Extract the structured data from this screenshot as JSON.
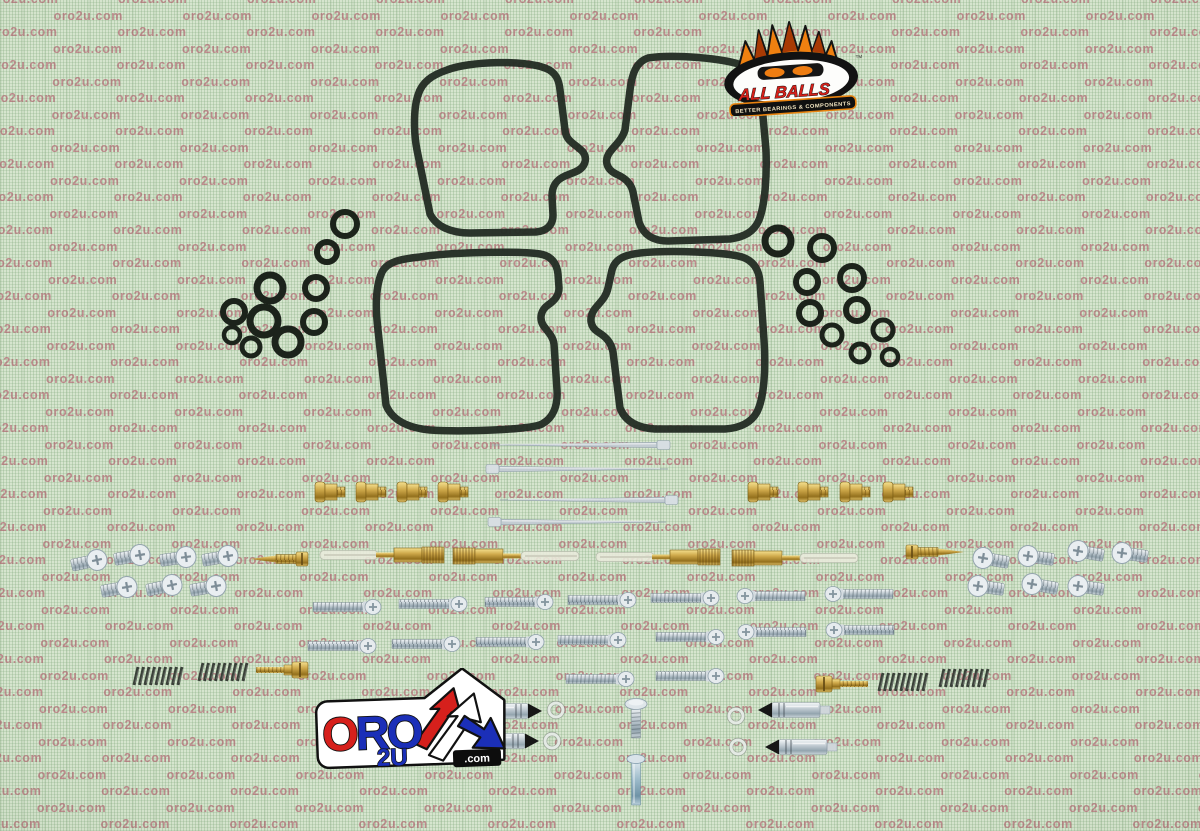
{
  "image": {
    "kind": "product-photo",
    "subject": "Carburetor rebuild kit parts laid out on a green mat",
    "width": 1200,
    "height": 831
  },
  "watermark": {
    "text": "oro2u.com",
    "color": "rgba(173,82,100,0.60)"
  },
  "background": {
    "base_color": "#d6e5ce",
    "grid_color": "#7da578"
  },
  "logos": {
    "all_balls": {
      "name": "ALL BALLS",
      "tagline": "BETTER BEARINGS & COMPONENTS",
      "trademark": "TM",
      "text_color": "#d5201a",
      "accent_orange": "#ef8010",
      "banner_bg": "#101010"
    },
    "oro2u": {
      "word": "ORO",
      "letters": [
        {
          "ch": "O",
          "color": "#d6201c"
        },
        {
          "ch": "R",
          "color": "#1b2fb8"
        },
        {
          "ch": "O",
          "color": "#1b2fb8"
        }
      ],
      "sub": "2U",
      "suffix": ".com",
      "red": "#d6201c",
      "blue": "#1b2fb8"
    }
  },
  "materials": {
    "brass": "#cfa94b",
    "steel": "#c2ccd3",
    "rubber_seal": "#1c231b"
  },
  "parts_counts": {
    "bowl_gaskets": 4,
    "o_rings_left_cluster": 10,
    "o_rings_right_cluster": 10,
    "jet_needles": 4,
    "brass_main_jets": 8,
    "needle_jet_emulsion_tubes": 4,
    "brass_pilot_screws": 2,
    "pan_head_screws_left": 7,
    "pan_head_screws_right": 7,
    "long_machine_screws": 16,
    "springs": 4,
    "brass_adjuster_screws": 2,
    "float_needle_valves": 4,
    "washers": 4,
    "vertical_screws": 2
  }
}
